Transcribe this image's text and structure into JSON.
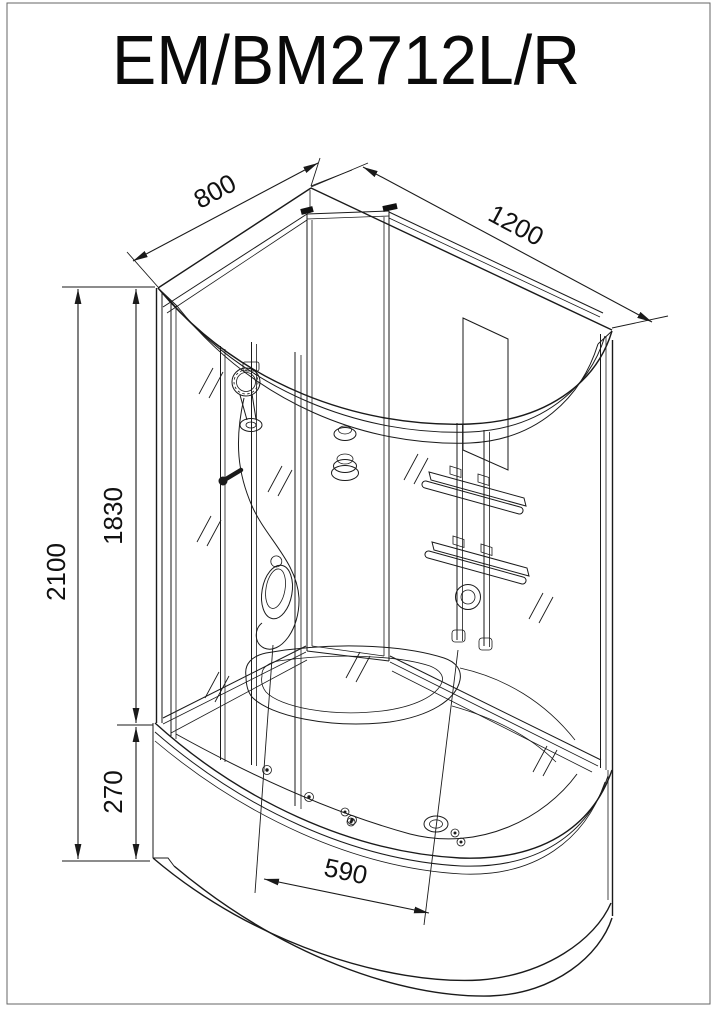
{
  "page": {
    "title": "EM/BM2712L/R"
  },
  "dimensions": {
    "depth": "800",
    "width": "1200",
    "total_height": "2100",
    "cabin_height": "1830",
    "tray_height": "270",
    "inner_width": "590"
  }
}
